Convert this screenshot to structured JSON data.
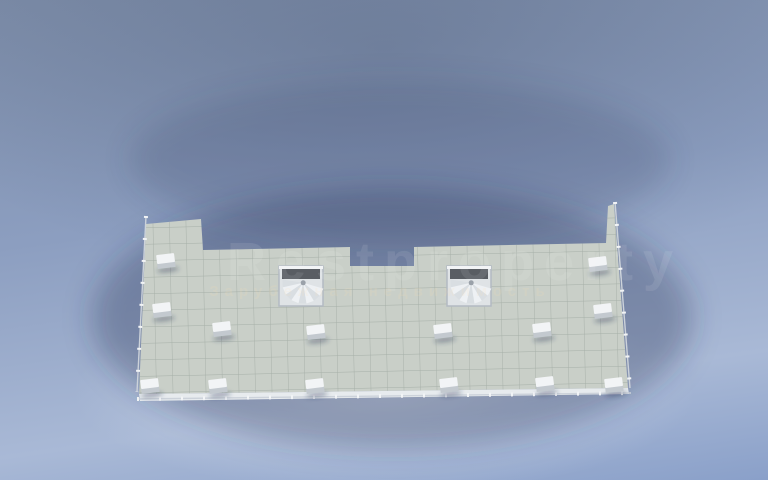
{
  "watermark": {
    "title": "Restproperty",
    "subtitle": "Зарубежная недвижимость"
  },
  "palette": {
    "bg1": "#7d8da9",
    "bg2": "#8c9ec0",
    "bg3": "#a9b9d6",
    "bg4": "#8aa0c9",
    "wall": "#f2f4f6",
    "wallShade": "#aeb6c0",
    "terr": "#c9cfc8",
    "terrGrid": "#9aa49c",
    "fascia": "#e7ebee",
    "apt": "#a6b4c8",
    "aptGrid": "#8193a9",
    "bay": "#90a1b5",
    "bath": "#b6bcb2",
    "bathGrid": "#98a096",
    "corr": "#83878f",
    "corrDark": "#6b6f77",
    "openDark": "#595d63",
    "dark": "#2e3236",
    "brown": "#a3765a",
    "brownD": "#875c43",
    "teal": "#9db2b3",
    "sofa": "#eceff2",
    "yellow": "#cdc279",
    "tread": "#a9b0b9",
    "rail": "#ccd2da",
    "shadow": "rgba(42,56,86,0.33)",
    "wm": "#ffffff"
  },
  "scene": {
    "terrace_outline": "146,224 201,219 203,250 350,247 350,266 414,266 414,247 606,243 608,206 614,204 628,388 139,394",
    "fascia_outline": "139,394 628,388 629,394 140,401",
    "corridor": {
      "x": 205,
      "y": 196,
      "w": 402,
      "h": 54
    },
    "vestibule": {
      "x": 350,
      "y": 242,
      "w": 64,
      "h": 26
    },
    "center_wall": {
      "x": 379,
      "y": 230,
      "w": 6,
      "h": 168
    },
    "center_cap": {
      "x": 371,
      "y": 394,
      "w": 24,
      "h": 14
    },
    "railings": [
      {
        "x1": 146,
        "y1": 216,
        "x2": 137,
        "y2": 392
      },
      {
        "x1": 137,
        "y1": 399,
        "x2": 631,
        "y2": 393
      },
      {
        "x1": 615,
        "y1": 202,
        "x2": 630,
        "y2": 388
      }
    ],
    "vents": [
      [
        166,
        262
      ],
      [
        162,
        311
      ],
      [
        150,
        387
      ],
      [
        222,
        330
      ],
      [
        218,
        387
      ],
      [
        316,
        333
      ],
      [
        315,
        387
      ],
      [
        443,
        332
      ],
      [
        449,
        386
      ],
      [
        542,
        331
      ],
      [
        545,
        385
      ],
      [
        603,
        312
      ],
      [
        614,
        386
      ],
      [
        598,
        265
      ]
    ],
    "spiral_stairs": [
      [
        279,
        266
      ],
      [
        447,
        266
      ]
    ],
    "straight_stairs": [
      [
        303,
        208
      ],
      [
        424,
        208
      ]
    ],
    "slabs": [
      {
        "t": "rect",
        "x": 164,
        "y": 82,
        "w": 84,
        "h": 54
      },
      {
        "t": "rect",
        "x": 358,
        "y": 76,
        "w": 44,
        "h": 22
      },
      {
        "t": "rect",
        "x": 514,
        "y": 80,
        "w": 90,
        "h": 56
      },
      {
        "t": "rect",
        "x": 598,
        "y": 104,
        "w": 62,
        "h": 70
      },
      {
        "t": "rect",
        "x": 152,
        "y": 92,
        "w": 16,
        "h": 20
      },
      {
        "t": "rect",
        "x": 250,
        "y": 94,
        "w": 16,
        "h": 12
      },
      {
        "t": "rect",
        "x": 332,
        "y": 88,
        "w": 16,
        "h": 12
      },
      {
        "t": "rect",
        "x": 422,
        "y": 84,
        "w": 16,
        "h": 12
      },
      {
        "t": "rect",
        "x": 496,
        "y": 86,
        "w": 16,
        "h": 12
      },
      {
        "t": "rect",
        "x": 640,
        "y": 78,
        "w": 18,
        "h": 16
      },
      {
        "t": "poly",
        "pts": "156,98 650,88 648,220 158,228"
      }
    ],
    "floors": [
      {
        "x": 172,
        "y": 88,
        "w": 68,
        "h": 40,
        "k": "bay"
      },
      {
        "x": 164,
        "y": 134,
        "w": 82,
        "h": 80,
        "k": "apt"
      },
      {
        "x": 250,
        "y": 110,
        "w": 36,
        "h": 52,
        "k": "apt"
      },
      {
        "x": 290,
        "y": 112,
        "w": 32,
        "h": 54,
        "k": "apt"
      },
      {
        "x": 326,
        "y": 110,
        "w": 55,
        "h": 76,
        "k": "apt"
      },
      {
        "x": 387,
        "y": 110,
        "w": 55,
        "h": 76,
        "k": "apt"
      },
      {
        "x": 446,
        "y": 112,
        "w": 32,
        "h": 54,
        "k": "apt"
      },
      {
        "x": 482,
        "y": 110,
        "w": 36,
        "h": 52,
        "k": "apt"
      },
      {
        "x": 516,
        "y": 88,
        "w": 86,
        "h": 82,
        "k": "apt"
      },
      {
        "x": 604,
        "y": 110,
        "w": 50,
        "h": 58,
        "k": "bay"
      },
      {
        "x": 560,
        "y": 174,
        "w": 50,
        "h": 42,
        "k": "apt"
      },
      {
        "x": 158,
        "y": 178,
        "w": 44,
        "h": 44,
        "k": "apt"
      },
      {
        "x": 204,
        "y": 178,
        "w": 30,
        "h": 40,
        "k": "bath"
      },
      {
        "x": 252,
        "y": 166,
        "w": 34,
        "h": 44,
        "k": "bath"
      },
      {
        "x": 296,
        "y": 168,
        "w": 26,
        "h": 26,
        "k": "bath"
      },
      {
        "x": 446,
        "y": 168,
        "w": 26,
        "h": 26,
        "k": "bath"
      },
      {
        "x": 482,
        "y": 166,
        "w": 34,
        "h": 44,
        "k": "bath"
      },
      {
        "x": 534,
        "y": 176,
        "w": 24,
        "h": 40,
        "k": "bath"
      }
    ],
    "walls": [
      [
        248,
        96,
        248,
        212
      ],
      [
        288,
        94,
        288,
        210
      ],
      [
        324,
        92,
        324,
        206
      ],
      [
        444,
        92,
        444,
        206
      ],
      [
        480,
        94,
        480,
        212
      ],
      [
        516,
        86,
        516,
        212
      ],
      [
        602,
        84,
        602,
        170
      ],
      [
        558,
        172,
        558,
        214
      ],
      [
        202,
        132,
        202,
        222
      ],
      [
        234,
        176,
        234,
        216
      ],
      [
        164,
        132,
        248,
        132
      ],
      [
        248,
        110,
        324,
        110
      ],
      [
        444,
        110,
        516,
        110
      ],
      [
        250,
        164,
        286,
        164
      ],
      [
        482,
        164,
        516,
        164
      ],
      [
        288,
        168,
        324,
        168
      ],
      [
        444,
        168,
        480,
        168
      ],
      [
        158,
        176,
        234,
        176
      ],
      [
        534,
        172,
        612,
        172
      ],
      [
        516,
        86,
        602,
        86
      ],
      [
        606,
        168,
        654,
        168
      ]
    ],
    "corridor_wall": [
      205,
      196,
      606,
      193
    ],
    "furniture": [
      {
        "t": "table6",
        "x": 190,
        "y": 99,
        "w": 30,
        "h": 14
      },
      {
        "t": "counter",
        "x": 166,
        "y": 150,
        "w": 12,
        "h": 58
      },
      {
        "t": "sofa",
        "x": 190,
        "y": 135,
        "w": 44,
        "h": 13
      },
      {
        "t": "rug",
        "x": 196,
        "y": 166,
        "w": 32,
        "h": 18
      },
      {
        "t": "bed",
        "x": 254,
        "y": 116,
        "w": 13,
        "h": 28,
        "c": "teal"
      },
      {
        "t": "bed",
        "x": 270,
        "y": 116,
        "w": 13,
        "h": 28,
        "c": "teal"
      },
      {
        "t": "bed",
        "x": 293,
        "y": 120,
        "w": 26,
        "h": 34,
        "c": "brown"
      },
      {
        "t": "sofa",
        "x": 338,
        "y": 118,
        "w": 28,
        "h": 13
      },
      {
        "t": "sofa",
        "x": 338,
        "y": 166,
        "w": 28,
        "h": 13
      },
      {
        "t": "sofa",
        "x": 366,
        "y": 130,
        "w": 12,
        "h": 30
      },
      {
        "t": "rug",
        "x": 342,
        "y": 140,
        "w": 20,
        "h": 17
      },
      {
        "t": "sofa",
        "x": 402,
        "y": 118,
        "w": 28,
        "h": 13
      },
      {
        "t": "sofa",
        "x": 402,
        "y": 166,
        "w": 28,
        "h": 13
      },
      {
        "t": "sofa",
        "x": 390,
        "y": 130,
        "w": 12,
        "h": 30
      },
      {
        "t": "rug",
        "x": 406,
        "y": 140,
        "w": 20,
        "h": 17
      },
      {
        "t": "tv",
        "x": 334,
        "y": 186,
        "w": 42,
        "h": 7
      },
      {
        "t": "tv",
        "x": 392,
        "y": 186,
        "w": 42,
        "h": 7
      },
      {
        "t": "bed",
        "x": 449,
        "y": 120,
        "w": 26,
        "h": 34,
        "c": "brown"
      },
      {
        "t": "bed",
        "x": 485,
        "y": 116,
        "w": 13,
        "h": 28,
        "c": "teal"
      },
      {
        "t": "bed",
        "x": 501,
        "y": 116,
        "w": 13,
        "h": 28,
        "c": "teal"
      },
      {
        "t": "sofa",
        "x": 542,
        "y": 91,
        "w": 36,
        "h": 14
      },
      {
        "t": "sofa",
        "x": 522,
        "y": 104,
        "w": 15,
        "h": 14,
        "r": -35
      },
      {
        "t": "sofa",
        "x": 580,
        "y": 106,
        "w": 15,
        "h": 14,
        "r": 35
      },
      {
        "t": "rug",
        "x": 550,
        "y": 112,
        "w": 24,
        "h": 13
      },
      {
        "t": "tv",
        "x": 540,
        "y": 149,
        "w": 34,
        "h": 8
      },
      {
        "t": "table6",
        "x": 612,
        "y": 124,
        "w": 26,
        "h": 14
      },
      {
        "t": "bed",
        "x": 570,
        "y": 181,
        "w": 28,
        "h": 28,
        "c": "brown"
      },
      {
        "t": "dresser",
        "x": 586,
        "y": 202,
        "w": 20,
        "h": 8
      },
      {
        "t": "bed",
        "x": 162,
        "y": 186,
        "w": 28,
        "h": 28,
        "c": "brown",
        "r": -6
      },
      {
        "t": "dresser",
        "x": 205,
        "y": 160,
        "w": 22,
        "h": 9
      },
      {
        "t": "toilet",
        "x": 214,
        "y": 200
      },
      {
        "t": "sink",
        "x": 226,
        "y": 186
      },
      {
        "t": "toilet",
        "x": 263,
        "y": 192
      },
      {
        "t": "sink",
        "x": 277,
        "y": 176
      },
      {
        "t": "toilet",
        "x": 305,
        "y": 182
      },
      {
        "t": "toilet",
        "x": 456,
        "y": 182
      },
      {
        "t": "toilet",
        "x": 496,
        "y": 192
      },
      {
        "t": "sink",
        "x": 488,
        "y": 176
      },
      {
        "t": "toilet",
        "x": 543,
        "y": 200
      },
      {
        "t": "sink",
        "x": 549,
        "y": 186
      },
      {
        "t": "door",
        "x": 246,
        "y": 142,
        "l": 14,
        "r": -35
      },
      {
        "t": "door",
        "x": 287,
        "y": 152,
        "l": 14,
        "r": 38
      },
      {
        "t": "door",
        "x": 323,
        "y": 136,
        "l": 14,
        "r": -38
      },
      {
        "t": "door",
        "x": 445,
        "y": 136,
        "l": 14,
        "r": 38
      },
      {
        "t": "door",
        "x": 479,
        "y": 152,
        "l": 14,
        "r": -38
      },
      {
        "t": "door",
        "x": 515,
        "y": 144,
        "l": 14,
        "r": 35
      },
      {
        "t": "door",
        "x": 238,
        "y": 178,
        "l": 13,
        "r": 55
      },
      {
        "t": "door",
        "x": 300,
        "y": 204,
        "l": 12,
        "r": 22
      },
      {
        "t": "door",
        "x": 464,
        "y": 204,
        "l": 12,
        "r": -22
      },
      {
        "t": "door",
        "x": 470,
        "y": 178,
        "l": 13,
        "r": -55
      },
      {
        "t": "door",
        "x": 203,
        "y": 168,
        "l": 12,
        "r": 20
      },
      {
        "t": "door",
        "x": 564,
        "y": 170,
        "l": 13,
        "r": -20
      }
    ]
  }
}
